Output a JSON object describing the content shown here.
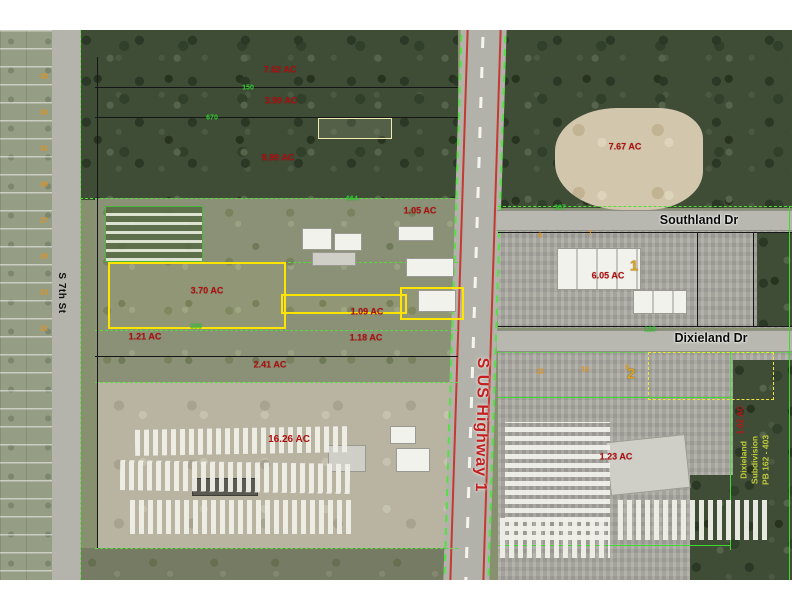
{
  "page": {
    "title": "Aerial parcel map"
  },
  "colors": {
    "subject_highlight": "#ffe400",
    "acreage_text": "#b01010",
    "boundary_green": "#58dc3c",
    "highway_text": "#c42020",
    "lot_number_orange": "#e2931a",
    "subdivision_note": "#c2cc3e"
  },
  "map": {
    "side_note": {
      "line1": "Dixieland",
      "line2": "Subdivision",
      "line3": "PB 162 - 403"
    },
    "labels": [
      {
        "t": "7.62 AC",
        "x": 280,
        "y": 40,
        "c": "acre",
        "n": "acreage"
      },
      {
        "t": "3.90 AC",
        "x": 281,
        "y": 71,
        "c": "acre",
        "n": "acreage"
      },
      {
        "t": "9.99 AC",
        "x": 278,
        "y": 128,
        "c": "acre",
        "n": "acreage"
      },
      {
        "t": "1.05 AC",
        "x": 420,
        "y": 181,
        "c": "acre",
        "n": "acreage"
      },
      {
        "t": "3.70 AC",
        "x": 207,
        "y": 261,
        "c": "acre",
        "n": "subject-acreage"
      },
      {
        "t": "1.09 AC",
        "x": 367,
        "y": 282,
        "c": "acre",
        "n": "acreage"
      },
      {
        "t": "1.18 AC",
        "x": 366,
        "y": 308,
        "c": "acre",
        "n": "acreage"
      },
      {
        "t": "1.21 AC",
        "x": 145,
        "y": 307,
        "c": "acre",
        "n": "acreage"
      },
      {
        "t": "2.41 AC",
        "x": 270,
        "y": 335,
        "c": "acre",
        "n": "acreage"
      },
      {
        "t": "16.26 AC",
        "x": 289,
        "y": 410,
        "c": "acre-big",
        "n": "acreage"
      },
      {
        "t": "7.67 AC",
        "x": 625,
        "y": 117,
        "c": "acre",
        "n": "acreage"
      },
      {
        "t": "6.05 AC",
        "x": 608,
        "y": 246,
        "c": "acre",
        "n": "acreage"
      },
      {
        "t": "1.23 AC",
        "x": 616,
        "y": 427,
        "c": "acre",
        "n": "acreage"
      },
      {
        "t": "1.02 AC",
        "x": 741,
        "y": 390,
        "c": "acre-v",
        "n": "acreage-vertical",
        "r": -90
      },
      {
        "t": "S 7th St",
        "x": 61,
        "y": 263,
        "c": "street-v",
        "n": "street-s-7th-st",
        "r": 90
      },
      {
        "t": "S US Highway 1",
        "x": 481,
        "y": 395,
        "c": "hwy",
        "n": "street-s-us-highway-1",
        "r": 91
      },
      {
        "t": "Southland Dr",
        "x": 699,
        "y": 190,
        "c": "street-h",
        "n": "street-southland-dr"
      },
      {
        "t": "Dixieland Dr",
        "x": 711,
        "y": 308,
        "c": "street-h",
        "n": "street-dixieland-dr"
      },
      {
        "t": "1",
        "x": 634,
        "y": 236,
        "c": "block",
        "n": "block-number"
      },
      {
        "t": "2",
        "x": 631,
        "y": 344,
        "c": "block",
        "n": "block-number"
      },
      {
        "t": "35",
        "x": 44,
        "y": 47,
        "c": "lot",
        "n": "lot-number"
      },
      {
        "t": "33",
        "x": 44,
        "y": 83,
        "c": "lot",
        "n": "lot-number"
      },
      {
        "t": "31",
        "x": 44,
        "y": 119,
        "c": "lot",
        "n": "lot-number"
      },
      {
        "t": "29",
        "x": 44,
        "y": 155,
        "c": "lot",
        "n": "lot-number"
      },
      {
        "t": "27",
        "x": 44,
        "y": 191,
        "c": "lot",
        "n": "lot-number"
      },
      {
        "t": "25",
        "x": 44,
        "y": 227,
        "c": "lot",
        "n": "lot-number"
      },
      {
        "t": "23",
        "x": 44,
        "y": 263,
        "c": "lot",
        "n": "lot-number"
      },
      {
        "t": "21",
        "x": 44,
        "y": 299,
        "c": "lot",
        "n": "lot-number"
      },
      {
        "t": "8",
        "x": 540,
        "y": 206,
        "c": "lot",
        "n": "lot-number"
      },
      {
        "t": "7",
        "x": 590,
        "y": 204,
        "c": "lot",
        "n": "lot-number"
      },
      {
        "t": "12",
        "x": 540,
        "y": 342,
        "c": "lot",
        "n": "lot-number"
      },
      {
        "t": "10",
        "x": 585,
        "y": 340,
        "c": "lot",
        "n": "lot-number"
      },
      {
        "t": "9",
        "x": 627,
        "y": 338,
        "c": "lot",
        "n": "lot-number"
      },
      {
        "t": "670",
        "x": 212,
        "y": 88,
        "c": "dim",
        "n": "dimension"
      },
      {
        "t": "150",
        "x": 248,
        "y": 58,
        "c": "dim",
        "n": "dimension"
      },
      {
        "t": "664",
        "x": 352,
        "y": 169,
        "c": "dim",
        "n": "dimension"
      },
      {
        "t": "330",
        "x": 196,
        "y": 297,
        "c": "dim",
        "n": "dimension"
      },
      {
        "t": "307",
        "x": 560,
        "y": 178,
        "c": "dim",
        "n": "dimension"
      },
      {
        "t": "125",
        "x": 650,
        "y": 300,
        "c": "dim",
        "n": "dimension"
      }
    ]
  }
}
